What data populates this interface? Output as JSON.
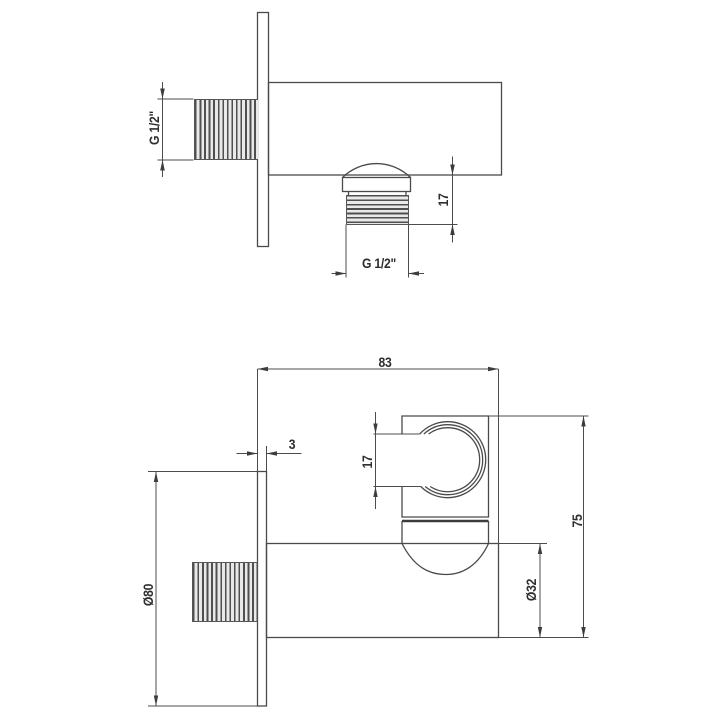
{
  "drawing_type": "technical-dimension-drawing",
  "colors": {
    "background": "#ffffff",
    "line": "#4a4a4a",
    "text": "#2e2e2e"
  },
  "views": {
    "side": {
      "name": "side-view",
      "inlet_thread_label": "G 1/2\"",
      "outlet_height_label": "17",
      "outlet_thread_label": "G 1/2\""
    },
    "front": {
      "name": "front-view",
      "width_label": "83",
      "plate_thickness_label": "3",
      "holder_slot_label": "17",
      "height_label": "75",
      "plate_diameter_label": "Ø80",
      "body_diameter_label": "Ø32"
    }
  }
}
